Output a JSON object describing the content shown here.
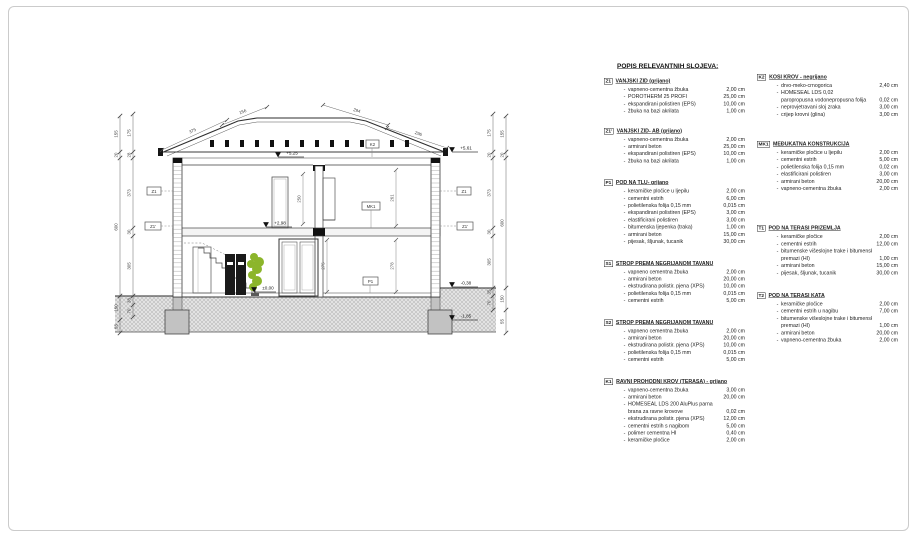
{
  "page": {
    "border_color": "#cbcbcb",
    "background": "#ffffff"
  },
  "legend": {
    "title": "POPIS RELEVANTNIH SLOJEVA:",
    "columns": [
      {
        "sections": [
          {
            "code": "Z1",
            "title": "VANJSKI ZID (grijano)",
            "items": [
              {
                "n": "vapneno-cementna žbuka",
                "v": "2,00 cm"
              },
              {
                "n": "POROTHERM 25 PROFI",
                "v": "25,00 cm"
              },
              {
                "n": "ekspandirani polistiren (EPS)",
                "v": "10,00 cm"
              },
              {
                "n": "žbuka na bazi akrilata",
                "v": "1,00 cm"
              }
            ]
          },
          {
            "code": "Z1'",
            "title": "VANJSKI ZID- AB (grijano)",
            "items": [
              {
                "n": "vapneno-cementna žbuka",
                "v": "2,00 cm"
              },
              {
                "n": "armirani beton",
                "v": "25,00 cm"
              },
              {
                "n": "ekspandirani polistiren (EPS)",
                "v": "10,00 cm"
              },
              {
                "n": "žbuka na bazi akrilata",
                "v": "1,00 cm"
              }
            ]
          },
          {
            "code": "P1",
            "title": "POD NA TLU- grijano",
            "items": [
              {
                "n": "keramičke pločice u ljepilu",
                "v": "2,00 cm"
              },
              {
                "n": "cementni estrih",
                "v": "6,00 cm"
              },
              {
                "n": "polietilenska folija 0,15 mm",
                "v": "0,015 cm"
              },
              {
                "n": "ekspandirani polistiren (EPS)",
                "v": "3,00 cm"
              },
              {
                "n": "elastificirani polistiren",
                "v": "3,00 cm"
              },
              {
                "n": "bitumenska ljepenka (traka)",
                "v": "1,00 cm"
              },
              {
                "n": "armirani beton",
                "v": "15,00 cm"
              },
              {
                "n": "pijesak, šljunak, tucanik",
                "v": "30,00 cm"
              }
            ]
          },
          {
            "code": "S1",
            "title": "STROP PREMA NEGRIJANOM TAVANU",
            "items": [
              {
                "n": "vapneno cementna žbuka",
                "v": "2,00 cm"
              },
              {
                "n": "armirani beton",
                "v": "20,00 cm"
              },
              {
                "n": "ekstrudirana polistir. pjena (XPS)",
                "v": "10,00 cm"
              },
              {
                "n": "polietilenska folija 0,15 mm",
                "v": "0,015 cm"
              },
              {
                "n": "cementni estrih",
                "v": "5,00 cm"
              }
            ]
          },
          {
            "code": "S2",
            "title": "STROP PREMA NEGRIJANOM TAVANU",
            "items": [
              {
                "n": "vapneno cementna žbuka",
                "v": "2,00 cm"
              },
              {
                "n": "armirani beton",
                "v": "20,00 cm"
              },
              {
                "n": "ekstrudirana polistir. pjena (XPS)",
                "v": "10,00 cm"
              },
              {
                "n": "polietilenska folija 0,15 mm",
                "v": "0,015 cm"
              },
              {
                "n": "cementni estrih",
                "v": "5,00 cm"
              }
            ]
          },
          {
            "code": "K1",
            "title": "RAVNI PROHODNI KROV (TERASA) - grijano",
            "items": [
              {
                "n": "vapneno-cementna žbuka",
                "v": "3,00 cm"
              },
              {
                "n": "armirani beton",
                "v": "20,00 cm"
              },
              {
                "n": "HOMESEAL LDS 200 AluPlus parna",
                "n2": "brana za ravne krovove",
                "v": "0,02 cm"
              },
              {
                "n": "ekstrudirana polistir. pjena (XPS)",
                "v": "12,00 cm"
              },
              {
                "n": "cementni estrih s nagibom",
                "v": "5,00 cm"
              },
              {
                "n": "polimer cementna HI",
                "v": "0,40 cm"
              },
              {
                "n": "keramičke pločice",
                "v": "2,00 cm"
              }
            ]
          }
        ]
      },
      {
        "sections": [
          {
            "code": "K2",
            "title": "KOSI KROV - negrijano",
            "items": [
              {
                "n": "drvo-meko-crnogorica",
                "v": "2,40 cm"
              },
              {
                "n": "HOMESEAL LDS 0,02",
                "n2": "paropropusna vodonepropusna folija",
                "v": "0,02 cm"
              },
              {
                "n": "neprovjetravani sloj zraka",
                "v": "3,00 cm"
              },
              {
                "n": "crijep krovni (glina)",
                "v": "3,00 cm"
              }
            ]
          },
          {
            "code": "MK1",
            "title": "MEĐUKATNA KONSTRUKCIJA",
            "items": [
              {
                "n": "keramičke pločice u ljepilu",
                "v": "2,00 cm"
              },
              {
                "n": "cementni estrih",
                "v": "5,00 cm"
              },
              {
                "n": "polietilenska folija 0,15 mm",
                "v": "0,02 cm"
              },
              {
                "n": "elastificirani polistiren",
                "v": "3,00 cm"
              },
              {
                "n": "armirani beton",
                "v": "20,00 cm"
              },
              {
                "n": "vapneno-cementna žbuka",
                "v": "2,00 cm"
              }
            ]
          },
          {
            "code": "T1",
            "title": "POD NA TERASI PRIZEMLJA",
            "items": [
              {
                "n": "keramičke pločice",
                "v": "2,00 cm"
              },
              {
                "n": "cementni estrih",
                "v": "12,00 cm"
              },
              {
                "n": "bitumenske višeslojne trake i bitumenski",
                "n2": "premazi (HI)",
                "v": "1,00 cm"
              },
              {
                "n": "armirani beton",
                "v": "15,00 cm"
              },
              {
                "n": "pijesak, šljunak, tucanik",
                "v": "30,00 cm"
              }
            ]
          },
          {
            "code": "T2",
            "title": "POD NA TERASI KATA",
            "items": [
              {
                "n": "keramičke pločice",
                "v": "2,00 cm"
              },
              {
                "n": "cementni estrih u nagibu",
                "v": "7,00 cm"
              },
              {
                "n": "bitumenske višeslojne trake i bitumenski",
                "n2": "premazi (HI)",
                "v": "1,00 cm"
              },
              {
                "n": "armirani beton",
                "v": "20,00 cm"
              },
              {
                "n": "vapneno-cementna žbuka",
                "v": "2,00 cm"
              }
            ]
          }
        ]
      }
    ]
  },
  "drawing": {
    "levels": [
      "+5,25",
      "+5,61",
      "+2,98",
      "±0,00",
      "-0,38",
      "-1,85"
    ],
    "slope_dims": [
      "375",
      "156",
      "294",
      "296"
    ],
    "room_dims": [
      "250",
      "261",
      "275",
      "278"
    ],
    "dim_chains": {
      "left_outer": [
        "155",
        "20",
        "600",
        "150",
        "55"
      ],
      "left_inner": [
        "175",
        "28",
        "373",
        "30",
        "305",
        "38",
        "70"
      ],
      "right_inner": [
        "175",
        "20",
        "373",
        "30",
        "305",
        "35",
        "70"
      ],
      "right_outer": [
        "155",
        "20",
        "600",
        "150",
        "55"
      ]
    },
    "ref_boxes": {
      "wall_left_top": "Z1",
      "wall_left_bottom": "Z1'",
      "wall_right_top": "Z1",
      "wall_right_bottom": "Z1'",
      "roof": "K2",
      "slab": "MK1",
      "floor": "P1"
    },
    "colors": {
      "plant": "#8cb52b",
      "foundation": "#c2c2c2",
      "line": "#3d3d3d",
      "terrain": "#9b9b9b"
    }
  }
}
